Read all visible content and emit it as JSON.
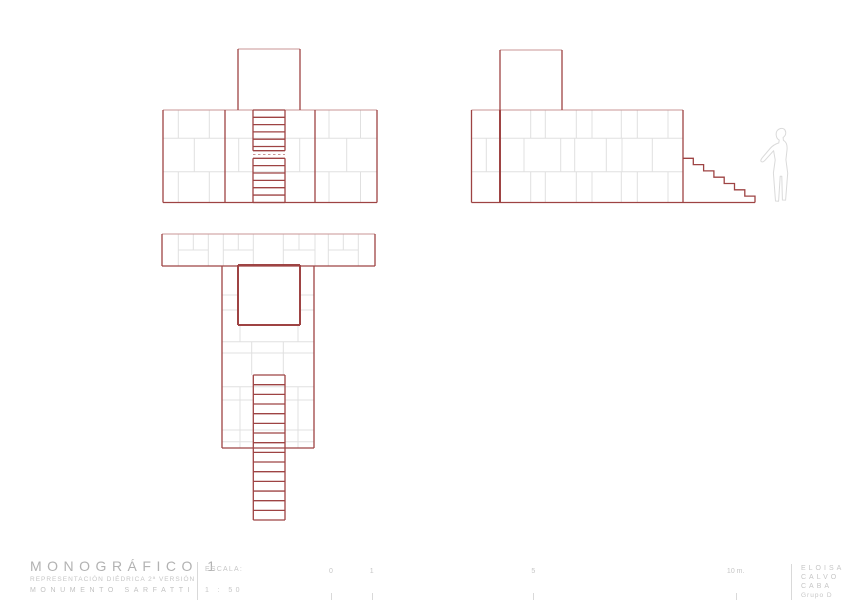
{
  "colors": {
    "red": "#9e4343",
    "red_light": "#c99595",
    "joint": "#e0e0e0",
    "figure": "#dadada",
    "text": "#c6c6c6",
    "rule": "#d9d9d9"
  },
  "titleblock": {
    "title": "MONOGRÁFICO 1",
    "subtitle": "REPRESENTACIÓN DIÉDRICA 2ª VERSIÓN",
    "project": "MONUMENTO SARFATTI",
    "scale_label": "ESCALA:",
    "scale_value": "1 : 50",
    "author": [
      "ELOISA",
      "CALVO",
      "CABA",
      "Grupo D"
    ]
  },
  "scalebar": {
    "ticks": [
      {
        "label": "0",
        "x": 331
      },
      {
        "label": "1",
        "x": 371.7
      },
      {
        "label": "5",
        "x": 533.3
      },
      {
        "label": "10 m.",
        "x": 735.7
      }
    ]
  },
  "views": {
    "front-elevation": {
      "g": [
        [
          163,
          138.3,
          377,
          138.3
        ],
        [
          163,
          171.7,
          377,
          171.7
        ],
        [
          178.3,
          110,
          178.3,
          138.3
        ],
        [
          209.3,
          110,
          209.3,
          138.3
        ],
        [
          329,
          110,
          329,
          138.3
        ],
        [
          360.5,
          110,
          360.5,
          138.3
        ],
        [
          178.3,
          171.7,
          178.3,
          202.5
        ],
        [
          209.3,
          171.7,
          209.3,
          202.5
        ],
        [
          329,
          171.7,
          329,
          202.5
        ],
        [
          360.5,
          171.7,
          360.5,
          202.5
        ],
        [
          194.3,
          138.3,
          194.3,
          171.7
        ],
        [
          238.7,
          138.3,
          238.7,
          171.7
        ],
        [
          299.7,
          138.3,
          299.7,
          171.7
        ],
        [
          346.7,
          138.3,
          346.7,
          171.7
        ]
      ],
      "p": [
        [
          163,
          110,
          377,
          110
        ],
        [
          238,
          49,
          300,
          49
        ]
      ],
      "d": [
        [
          253,
          154.5,
          285,
          154.5
        ]
      ],
      "r": [
        [
          163,
          110,
          163,
          202.5
        ],
        [
          377,
          110,
          377,
          202.5
        ],
        [
          163,
          202.5,
          377,
          202.5
        ],
        [
          225,
          110,
          225,
          202.5
        ],
        [
          315,
          110,
          315,
          202.5
        ],
        [
          238,
          49,
          238,
          110
        ],
        [
          300,
          49,
          300,
          110
        ]
      ],
      "ladders": [
        {
          "x1": 253,
          "x2": 285,
          "top": 110,
          "bot": 150.7,
          "step": 7.3
        },
        {
          "x1": 253,
          "x2": 285,
          "top": 158.3,
          "bot": 202.5,
          "step": 7.35
        }
      ]
    },
    "side-elevation": {
      "g": [
        [
          471.5,
          138.3,
          683,
          138.3
        ],
        [
          471.5,
          171.7,
          683,
          171.7
        ],
        [
          530.7,
          110,
          530.7,
          138.3
        ],
        [
          545.3,
          110,
          545.3,
          138.3
        ],
        [
          576.3,
          110,
          576.3,
          138.3
        ],
        [
          592,
          110,
          592,
          138.3
        ],
        [
          621.3,
          110,
          621.3,
          138.3
        ],
        [
          637.3,
          110,
          637.3,
          138.3
        ],
        [
          668,
          110,
          668,
          138.3
        ],
        [
          530.7,
          171.7,
          530.7,
          202.5
        ],
        [
          545.3,
          171.7,
          545.3,
          202.5
        ],
        [
          576.3,
          171.7,
          576.3,
          202.5
        ],
        [
          592,
          171.7,
          592,
          202.5
        ],
        [
          621.3,
          171.7,
          621.3,
          202.5
        ],
        [
          637.3,
          171.7,
          637.3,
          202.5
        ],
        [
          668,
          171.7,
          668,
          202.5
        ],
        [
          486.3,
          138.3,
          486.3,
          171.7
        ],
        [
          524,
          138.3,
          524,
          171.7
        ],
        [
          560.7,
          138.3,
          560.7,
          171.7
        ],
        [
          574.7,
          138.3,
          574.7,
          171.7
        ],
        [
          606.3,
          138.3,
          606.3,
          171.7
        ],
        [
          622,
          138.3,
          622,
          171.7
        ],
        [
          652.3,
          138.3,
          652.3,
          171.7
        ]
      ],
      "p": [
        [
          471.5,
          110,
          683,
          110
        ],
        [
          500,
          50,
          562,
          50
        ]
      ],
      "r": [
        [
          471.5,
          110,
          471.5,
          202.5
        ],
        [
          683,
          110,
          683,
          202.5
        ],
        [
          471.5,
          202.5,
          683,
          202.5
        ],
        [
          500,
          50,
          500,
          110
        ],
        [
          562,
          50,
          562,
          110
        ],
        [
          683,
          202.5,
          755,
          202.5
        ]
      ],
      "R": [
        [
          500,
          110,
          500,
          202.5
        ]
      ],
      "polys": [
        [
          [
            683,
            158.3
          ],
          [
            693.3,
            158.3
          ],
          [
            693.3,
            164.6
          ],
          [
            703.6,
            164.6
          ],
          [
            703.6,
            170.9
          ],
          [
            713.9,
            170.9
          ],
          [
            713.9,
            177.2
          ],
          [
            724.2,
            177.2
          ],
          [
            724.2,
            183.5
          ],
          [
            734.5,
            183.5
          ],
          [
            734.5,
            189.8
          ],
          [
            744.8,
            189.8
          ],
          [
            744.8,
            196.1
          ],
          [
            755,
            196.1
          ],
          [
            755,
            202.5
          ]
        ]
      ]
    },
    "plan-view": {
      "g": [
        [
          178.3,
          234,
          178.3,
          266
        ],
        [
          208.3,
          234,
          208.3,
          266
        ],
        [
          223.3,
          234,
          223.3,
          266
        ],
        [
          253.3,
          234,
          253.3,
          266
        ],
        [
          283.3,
          234,
          283.3,
          266
        ],
        [
          315,
          234,
          315,
          266
        ],
        [
          328.3,
          234,
          328.3,
          266
        ],
        [
          358.3,
          234,
          358.3,
          266
        ],
        [
          178.3,
          250,
          208.3,
          250
        ],
        [
          223.3,
          250,
          253.3,
          250
        ],
        [
          283.3,
          250,
          315,
          250
        ],
        [
          328.3,
          250,
          358.3,
          250
        ],
        [
          193.3,
          234,
          193.3,
          250
        ],
        [
          238.3,
          234,
          238.3,
          250
        ],
        [
          299,
          234,
          299,
          250
        ],
        [
          343.3,
          234,
          343.3,
          250
        ],
        [
          222,
          295,
          238,
          295
        ],
        [
          300,
          295,
          314,
          295
        ],
        [
          222,
          310,
          238,
          310
        ],
        [
          300,
          310,
          314,
          310
        ],
        [
          222,
          341.7,
          314,
          341.7
        ],
        [
          222,
          353,
          314,
          353
        ],
        [
          222,
          386.7,
          314,
          386.7
        ],
        [
          222,
          430,
          314,
          430
        ],
        [
          222,
          400,
          253,
          400
        ],
        [
          285,
          400,
          314,
          400
        ],
        [
          222,
          441.7,
          253,
          441.7
        ],
        [
          285,
          441.7,
          314,
          441.7
        ],
        [
          240,
          325,
          240,
          341.7
        ],
        [
          298,
          325,
          298,
          341.7
        ],
        [
          251.7,
          341.7,
          251.7,
          375
        ],
        [
          283.3,
          341.7,
          283.3,
          375
        ],
        [
          240,
          386.7,
          240,
          430
        ],
        [
          298,
          386.7,
          298,
          430
        ],
        [
          240,
          430,
          240,
          448
        ],
        [
          298,
          430,
          298,
          448
        ]
      ],
      "p": [
        [
          162,
          234,
          375,
          234
        ]
      ],
      "r": [
        [
          162,
          234,
          162,
          266
        ],
        [
          375,
          234,
          375,
          266
        ],
        [
          162,
          266,
          375,
          266
        ],
        [
          222,
          266,
          222,
          448
        ],
        [
          314,
          266,
          314,
          448
        ],
        [
          222,
          448,
          314,
          448
        ]
      ],
      "R": [
        [
          238,
          265,
          238,
          325
        ],
        [
          300,
          265,
          300,
          325
        ],
        [
          238,
          265,
          300,
          265
        ],
        [
          238,
          325,
          300,
          325
        ]
      ],
      "ladders": [
        {
          "x1": 253.3,
          "x2": 285,
          "top": 375,
          "bot": 520,
          "step": 9.67
        }
      ]
    },
    "human-figure": {
      "path": "M 780.5 128.5 C 777.3 129.4 775.9 132 776.2 135.1 C 776.4 137.4 777.5 139.2 779.2 140.1 L 778.8 142.9 C 775.2 144.1 772.3 145.9 770.1 148.5 L 762.3 157.7 C 760.8 159.5 760.4 160.9 761.3 161.6 C 762.2 162.3 763.8 161.7 765.1 160.2 L 773.6 150.7 L 775.2 159.9 L 773.4 173 L 775.5 201 L 778.6 201.2 L 780.2 176.2 L 781.8 176.2 L 782.4 200 L 785.6 200.1 L 787.7 173.2 L 785.9 159.7 L 787 150.1 C 787.6 144.7 786.4 141.9 783.4 140.3 L 783.1 137.4 C 785 136.3 785.9 134.3 785.7 132.2 C 785.4 129.4 783.3 127.9 780.5 128.5 Z"
    }
  }
}
